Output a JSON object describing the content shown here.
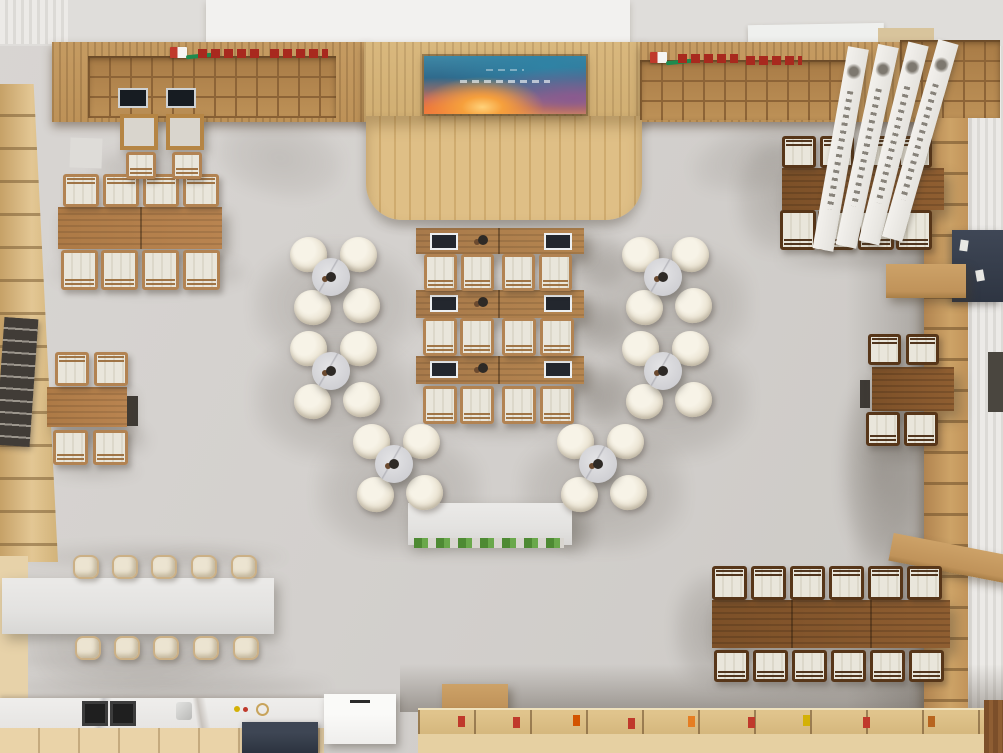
{
  "meta": {
    "description": "Top-down 3D render of a library reading room / book cafe interior",
    "view": "overhead"
  },
  "palette": {
    "floor": "#d3d0cd",
    "wood_wall": "#c59b62",
    "stage_wood": "#dcbc84",
    "shelf_left": "#ddc08d",
    "shelf_right": "#c2945a",
    "table_dark": "#7d5128",
    "table_medium": "#b28049",
    "desk_wood": "#ab7c4c",
    "chair_frame_dark": "#573619",
    "chair_frame_light": "#b28352",
    "cushion": "#e9e6db",
    "round_chair_cream": "#ece6d7",
    "marble_table": "#d6d6d8",
    "white_surface": "#e5e4e2",
    "cabinet_beige": "#ead3a8",
    "counter_tan": "#d4b67c",
    "navy": "#3e4654",
    "signage_red": "#a8291e",
    "logo_green": "#1d8a4e",
    "plant_green": "#4e8a33",
    "screen_teal": "#3e88a6",
    "screen_orange": "#f59a47",
    "gold": "#cbb086"
  },
  "scene": {
    "shadows": [
      [
        688,
        118,
        170,
        70,
        0.16,
        -15
      ],
      [
        215,
        118,
        130,
        80,
        0.14,
        12
      ],
      [
        735,
        140,
        90,
        115,
        0.22,
        0
      ],
      [
        840,
        372,
        78,
        190,
        0.3,
        0
      ],
      [
        672,
        572,
        85,
        115,
        0.24,
        0
      ],
      [
        52,
        252,
        195,
        42,
        0.26,
        0
      ],
      [
        38,
        418,
        112,
        44,
        0.26,
        0
      ],
      [
        560,
        234,
        70,
        56,
        0.26,
        0
      ],
      [
        560,
        300,
        70,
        56,
        0.26,
        0
      ],
      [
        560,
        366,
        70,
        58,
        0.26,
        0
      ],
      [
        374,
        210,
        262,
        20,
        0.22,
        0
      ],
      [
        92,
        148,
        115,
        40,
        0.18,
        0
      ],
      [
        18,
        544,
        268,
        26,
        0.16,
        0
      ],
      [
        4,
        640,
        286,
        38,
        0.2,
        0
      ],
      [
        566,
        508,
        30,
        46,
        0.26,
        0
      ],
      [
        30,
        556,
        250,
        130,
        0.08,
        -16
      ],
      [
        0,
        672,
        330,
        30,
        0.2,
        0
      ],
      [
        420,
        286,
        165,
        18,
        0.2,
        0
      ],
      [
        420,
        352,
        165,
        18,
        0.2,
        0
      ],
      [
        420,
        420,
        165,
        18,
        0.2,
        0
      ],
      [
        778,
        248,
        170,
        22,
        0.2,
        0
      ],
      [
        710,
        676,
        245,
        20,
        0.2,
        0
      ],
      [
        862,
        444,
        90,
        18,
        0.2,
        0
      ],
      [
        48,
        462,
        92,
        18,
        0.18,
        0
      ]
    ],
    "tables": [
      {
        "x": 58,
        "y": 207,
        "w": 164,
        "h": 42,
        "style": "wood-mid",
        "div": [
          82
        ]
      },
      {
        "x": 47,
        "y": 387,
        "w": 80,
        "h": 40,
        "style": "wood-mid",
        "div": []
      },
      {
        "x": 782,
        "y": 168,
        "w": 162,
        "h": 42,
        "style": "wood-dark",
        "div": [
          81
        ]
      },
      {
        "x": 872,
        "y": 367,
        "w": 82,
        "h": 44,
        "style": "wood-dark",
        "div": []
      },
      {
        "x": 712,
        "y": 600,
        "w": 238,
        "h": 48,
        "style": "wood-dark",
        "div": [
          79,
          158
        ]
      },
      {
        "x": 120,
        "y": 114,
        "w": 38,
        "h": 36,
        "style": "wood-frame",
        "div": []
      },
      {
        "x": 166,
        "y": 114,
        "w": 38,
        "h": 36,
        "style": "wood-frame",
        "div": []
      }
    ],
    "desk_rows": [
      {
        "y": 228,
        "h": 26
      },
      {
        "y": 290,
        "h": 28
      },
      {
        "y": 356,
        "h": 28
      }
    ],
    "dark_chairs": [
      [
        782,
        136,
        34,
        32,
        "n"
      ],
      [
        820,
        136,
        34,
        32,
        "n"
      ],
      [
        860,
        136,
        34,
        32,
        "n"
      ],
      [
        898,
        136,
        34,
        32,
        "n"
      ],
      [
        780,
        210,
        36,
        40,
        "s"
      ],
      [
        818,
        210,
        36,
        40,
        "s"
      ],
      [
        858,
        210,
        36,
        40,
        "s"
      ],
      [
        896,
        210,
        36,
        40,
        "s"
      ],
      [
        868,
        334,
        33,
        31,
        "n"
      ],
      [
        906,
        334,
        33,
        31,
        "n"
      ],
      [
        866,
        412,
        34,
        34,
        "s"
      ],
      [
        904,
        412,
        34,
        34,
        "s"
      ],
      [
        712,
        566,
        35,
        34,
        "n"
      ],
      [
        751,
        566,
        35,
        34,
        "n"
      ],
      [
        790,
        566,
        35,
        34,
        "n"
      ],
      [
        829,
        566,
        35,
        34,
        "n"
      ],
      [
        868,
        566,
        35,
        34,
        "n"
      ],
      [
        907,
        566,
        35,
        34,
        "n"
      ],
      [
        714,
        650,
        35,
        32,
        "s"
      ],
      [
        753,
        650,
        35,
        32,
        "s"
      ],
      [
        792,
        650,
        35,
        32,
        "s"
      ],
      [
        831,
        650,
        35,
        32,
        "s"
      ],
      [
        870,
        650,
        35,
        32,
        "s"
      ],
      [
        909,
        650,
        35,
        32,
        "s"
      ]
    ],
    "light_chairs": [
      [
        63,
        174,
        36,
        33,
        "n"
      ],
      [
        103,
        174,
        36,
        33,
        "n"
      ],
      [
        143,
        174,
        36,
        33,
        "n"
      ],
      [
        183,
        174,
        36,
        33,
        "n"
      ],
      [
        61,
        250,
        37,
        40,
        "s"
      ],
      [
        101,
        250,
        37,
        40,
        "s"
      ],
      [
        142,
        250,
        37,
        40,
        "s"
      ],
      [
        183,
        250,
        37,
        40,
        "s"
      ],
      [
        55,
        352,
        34,
        34,
        "n"
      ],
      [
        94,
        352,
        34,
        34,
        "n"
      ],
      [
        53,
        430,
        35,
        35,
        "s"
      ],
      [
        93,
        430,
        35,
        35,
        "s"
      ],
      [
        424,
        254,
        33,
        37,
        "s"
      ],
      [
        461,
        254,
        33,
        37,
        "s"
      ],
      [
        502,
        254,
        33,
        37,
        "s"
      ],
      [
        539,
        254,
        33,
        37,
        "s"
      ],
      [
        423,
        318,
        34,
        38,
        "s"
      ],
      [
        460,
        318,
        34,
        38,
        "s"
      ],
      [
        502,
        318,
        34,
        38,
        "s"
      ],
      [
        540,
        318,
        34,
        38,
        "s"
      ],
      [
        423,
        386,
        34,
        38,
        "s"
      ],
      [
        460,
        386,
        34,
        38,
        "s"
      ],
      [
        502,
        386,
        34,
        38,
        "s"
      ],
      [
        540,
        386,
        34,
        38,
        "s"
      ],
      [
        126,
        152,
        30,
        27,
        "s"
      ],
      [
        172,
        152,
        30,
        27,
        "s"
      ]
    ],
    "round_clusters": [
      {
        "cx": 331,
        "cy": 277
      },
      {
        "cx": 331,
        "cy": 371
      },
      {
        "cx": 394,
        "cy": 464
      },
      {
        "cx": 663,
        "cy": 277
      },
      {
        "cx": 663,
        "cy": 371
      },
      {
        "cx": 598,
        "cy": 464
      }
    ],
    "stools": [
      [
        73,
        555
      ],
      [
        112,
        555
      ],
      [
        151,
        555
      ],
      [
        191,
        555
      ],
      [
        231,
        555
      ],
      [
        75,
        636
      ],
      [
        114,
        636
      ],
      [
        153,
        636
      ],
      [
        193,
        636
      ],
      [
        233,
        636
      ]
    ]
  }
}
